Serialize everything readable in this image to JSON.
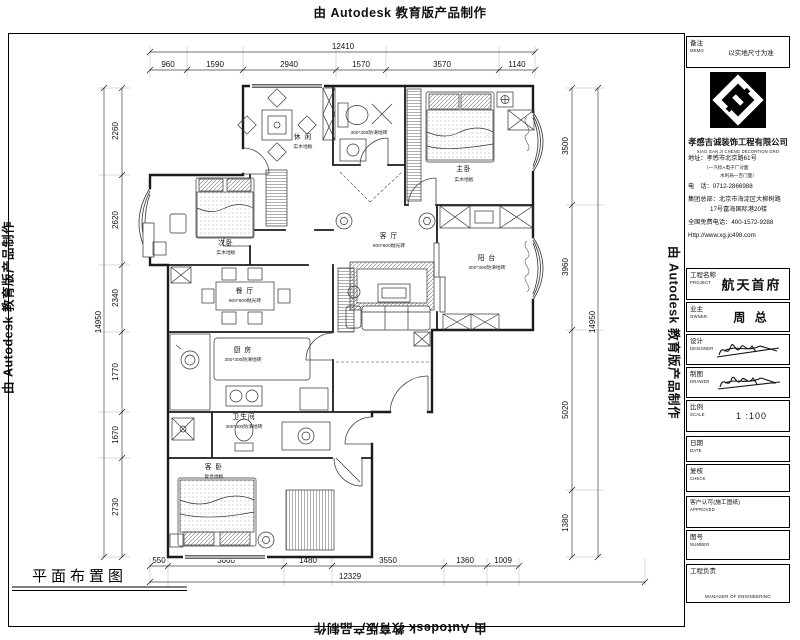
{
  "watermark": {
    "text": "由 Autodesk 教育版产品制作"
  },
  "plan": {
    "title": "平面布置图",
    "rooms": {
      "leisure": {
        "name": "休 闲",
        "floor": "实木地板"
      },
      "bath_top": {
        "floor": "300*300防滑地砖"
      },
      "master_bedroom": {
        "name": "主卧",
        "floor": "实木地板"
      },
      "second_bedroom": {
        "name": "次卧",
        "floor": "实木地板"
      },
      "dining": {
        "name": "餐 厅",
        "floor": "800*800抛光砖"
      },
      "living": {
        "name": "客 厅",
        "floor": "800*800抛光砖"
      },
      "balcony": {
        "name": "阳 台",
        "floor": "300*300防滑地砖"
      },
      "kitchen": {
        "name": "厨 房",
        "floor": "300*300防滑地砖"
      },
      "bath_bottom": {
        "name": "卫生间",
        "floor": "300*300防滑地砖"
      },
      "guest_bedroom": {
        "name": "客 卧",
        "floor": "复合地板"
      }
    },
    "dims": {
      "top": {
        "total": "12410",
        "segments": [
          "960",
          "1590",
          "2940",
          "1570",
          "3570",
          "1140"
        ]
      },
      "left": {
        "total": "14950",
        "segments": [
          "2260",
          "2620",
          "2340",
          "1770",
          "1670",
          "2730"
        ]
      },
      "right": {
        "total": "14950",
        "segments": [
          "3500",
          "3960",
          "5020",
          "1380"
        ]
      },
      "bottom": {
        "total": "12329",
        "segments": [
          "550",
          "3660",
          "1480",
          "3550",
          "1360",
          "1009"
        ]
      }
    }
  },
  "titleblock": {
    "memo": {
      "label": "备注",
      "label_en": "MEMO",
      "value": "以实地尺寸为准"
    },
    "company": {
      "name": "孝感吉诚装饰工程有限公司",
      "name_en": "XIAO GAN JI CHENG DECORTION GRO"
    },
    "contact": {
      "address_label": "地址：",
      "address": "孝感市北京路61号",
      "address_note1": "（一汽综A电子厂对面",
      "address_note2": "水利局一百门面）",
      "phone_label": "电　话：",
      "phone": "0712-2866988",
      "hq_label": "集团总部：",
      "hq_line1": "北京市海淀区大柳树路",
      "hq_line2": "17号富海国际港20楼",
      "hotline_label": "全国免费电话：",
      "hotline": "400-1572-9288",
      "website": "Http://www.xg.jc498.com"
    },
    "rows": {
      "project": {
        "label": "工程名称",
        "label_en": "PROJECT",
        "value": "航天首府"
      },
      "owner": {
        "label": "业主",
        "label_en": "OWNER",
        "value": "周 总"
      },
      "designer": {
        "label": "设计",
        "label_en": "DESIGNER"
      },
      "drawer": {
        "label": "制图",
        "label_en": "DRAWER"
      },
      "scale": {
        "label": "比例",
        "label_en": "SCALE",
        "value": "1 :100"
      },
      "date": {
        "label": "日期",
        "label_en": "DATE"
      },
      "check": {
        "label": "复核",
        "label_en": "CHECK"
      },
      "approved": {
        "label": "客户认可(施工图纸)",
        "label_en": "APPROVED"
      },
      "number": {
        "label": "图号",
        "label_en": "NUMBER"
      },
      "manager": {
        "label": "工程负责",
        "label_en": "MANAGER OF ENGINEERING"
      }
    }
  }
}
